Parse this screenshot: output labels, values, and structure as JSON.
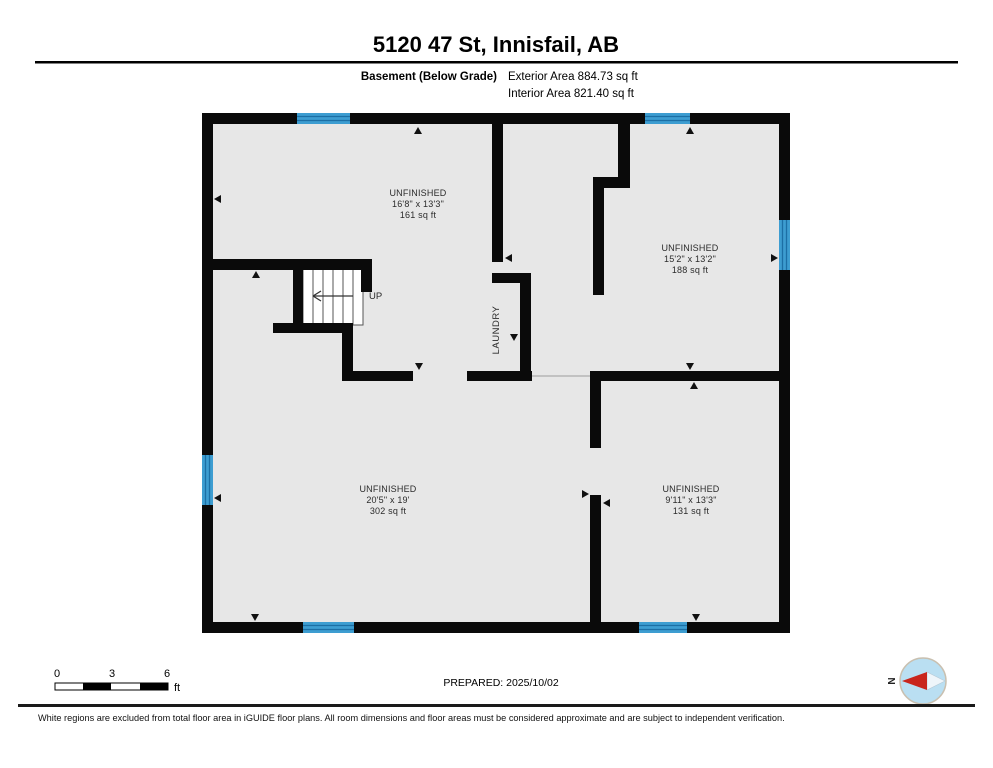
{
  "header": {
    "title": "5120 47 St, Innisfail, AB",
    "floor_label": "Basement (Below Grade)",
    "exterior_area": "Exterior Area 884.73 sq ft",
    "interior_area": "Interior Area 821.40 sq ft"
  },
  "plan": {
    "rooms": [
      {
        "name": "UNFINISHED",
        "dims": "16'8\" x 13'3\"",
        "area": "161 sq ft"
      },
      {
        "name": "UNFINISHED",
        "dims": "15'2\" x 13'2\"",
        "area": "188 sq ft"
      },
      {
        "name": "UNFINISHED",
        "dims": "20'5\" x 19'",
        "area": "302 sq ft"
      },
      {
        "name": "UNFINISHED",
        "dims": "9'11\" x 13'3\"",
        "area": "131 sq ft"
      }
    ],
    "stairs_label": "UP",
    "laundry_label": "LAUNDRY"
  },
  "scale_bar": {
    "ticks": [
      "0",
      "3",
      "6"
    ],
    "unit": "ft"
  },
  "prepared_label": "PREPARED: 2025/10/02",
  "compass": {
    "north_label": "N"
  },
  "footer": {
    "disclaimer": "White regions are excluded from total floor area in iGUIDE floor plans. All room dimensions and floor areas must be considered approximate and are subject to independent verification."
  },
  "colors": {
    "wall": "#0a0a0a",
    "floor": "#e7e7e7",
    "window": "#3d9dd1",
    "window_stripe": "#1c6fa5",
    "compass_red": "#c9251c",
    "compass_fill": "#badff2"
  }
}
